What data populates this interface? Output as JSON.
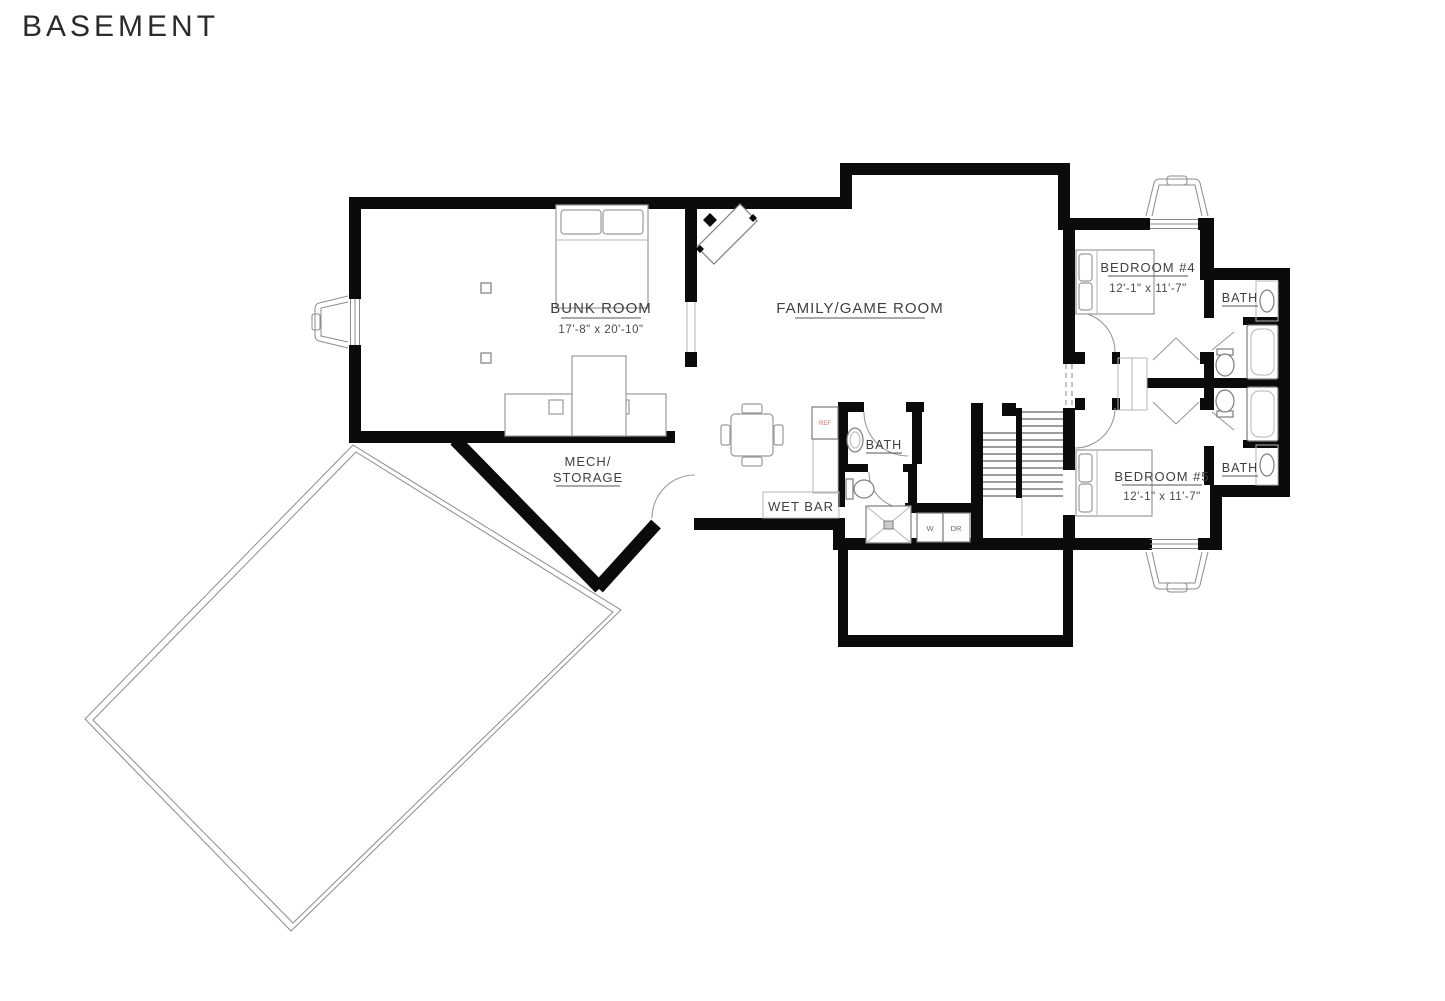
{
  "labels": {
    "title": "BASEMENT",
    "bunk": {
      "name": "BUNK ROOM",
      "dims": "17'-8\" x 20'-10\""
    },
    "family": {
      "name": "FAMILY/GAME ROOM"
    },
    "mech": {
      "line1": "MECH/",
      "line2": "STORAGE"
    },
    "wet_bar": {
      "name": "WET BAR"
    },
    "bath_main": {
      "name": "BATH"
    },
    "bed4": {
      "name": "BEDROOM #4",
      "dims": "12'-1\" x 11'-7\""
    },
    "bed5": {
      "name": "BEDROOM #5",
      "dims": "12'-1\" x 11'-7\""
    },
    "bath_upper": {
      "name": "BATH"
    },
    "bath_lower": {
      "name": "BATH"
    },
    "laundry": {
      "washer": "W",
      "dryer": "DR"
    },
    "fridge": "REF"
  },
  "colors": {
    "wall": "#0b0b0b",
    "furniture_line": "#9a9a9a",
    "label_text": "#3f3f3f",
    "fridge_text": "#d06a6a",
    "background": "#ffffff"
  }
}
